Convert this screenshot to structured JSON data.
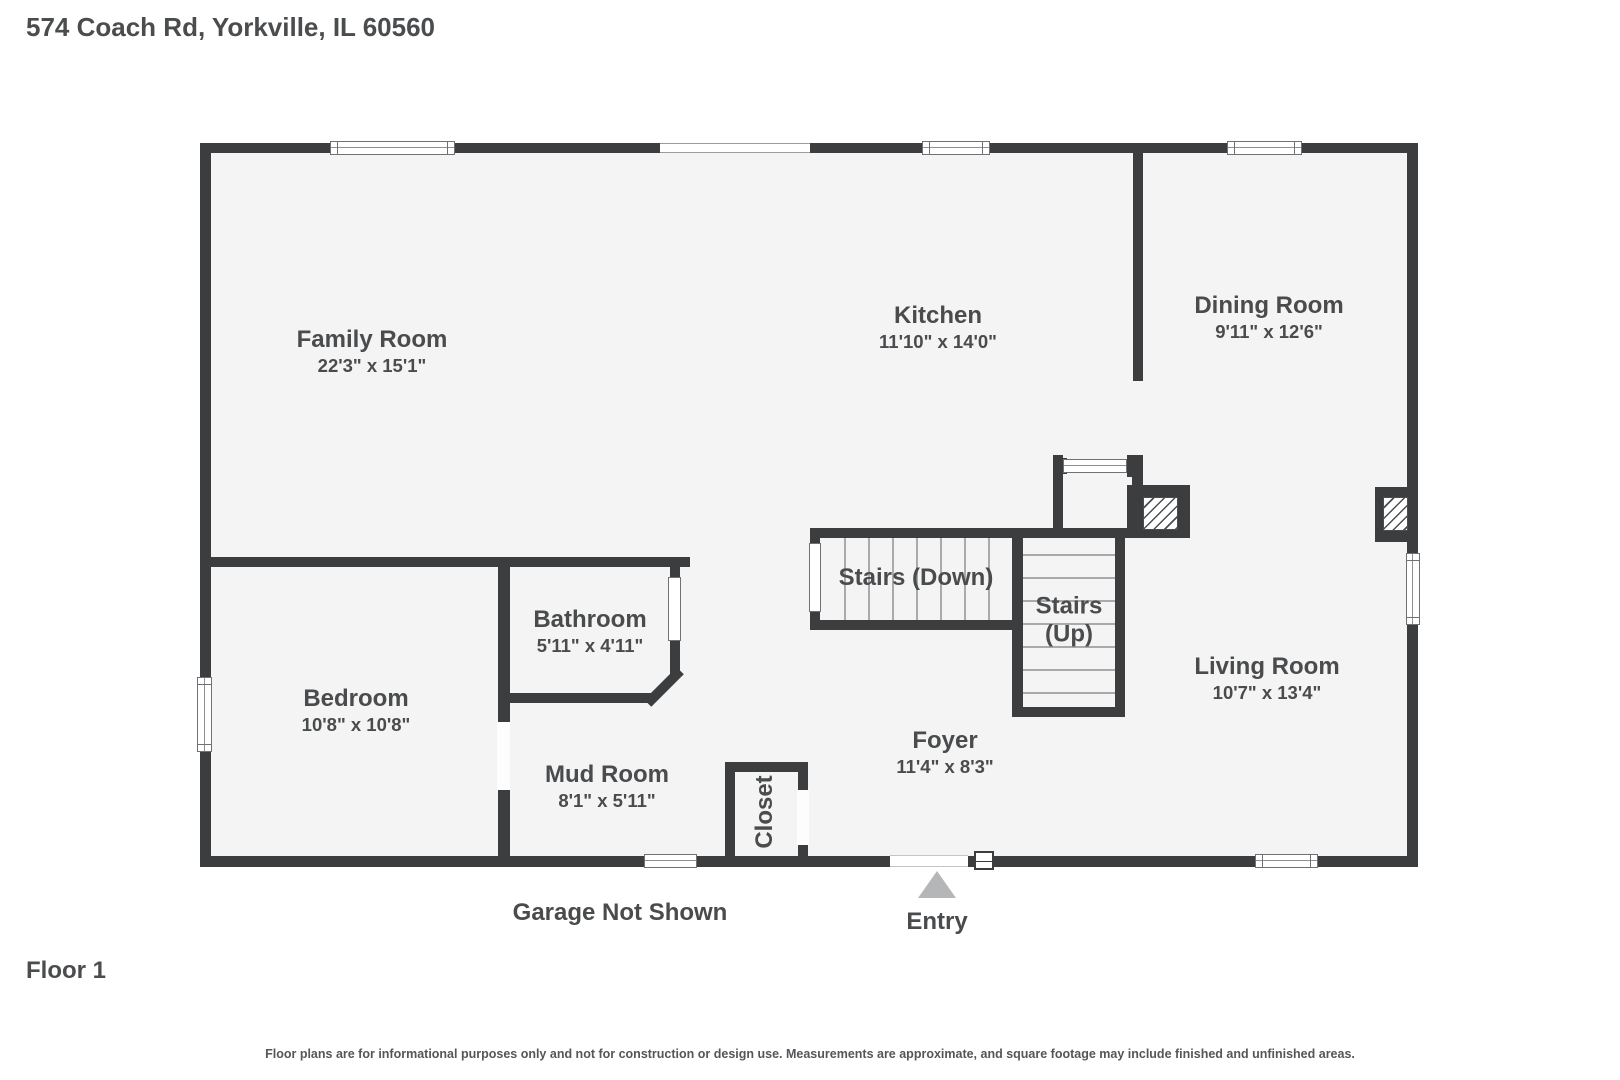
{
  "header": {
    "address": "574 Coach Rd, Yorkville, IL 60560"
  },
  "rooms": {
    "family_room": {
      "name": "Family Room",
      "dims": "22'3\" x 15'1\""
    },
    "kitchen": {
      "name": "Kitchen",
      "dims": "11'10\" x 14'0\""
    },
    "dining_room": {
      "name": "Dining Room",
      "dims": "9'11\" x 12'6\""
    },
    "living_room": {
      "name": "Living Room",
      "dims": "10'7\" x 13'4\""
    },
    "bathroom": {
      "name": "Bathroom",
      "dims": "5'11\" x 4'11\""
    },
    "bedroom": {
      "name": "Bedroom",
      "dims": "10'8\" x 10'8\""
    },
    "mud_room": {
      "name": "Mud Room",
      "dims": "8'1\" x 5'11\""
    },
    "foyer": {
      "name": "Foyer",
      "dims": "11'4\" x 8'3\""
    },
    "stairs_down": {
      "name": "Stairs (Down)"
    },
    "stairs_up": {
      "name": "Stairs (Up)"
    },
    "closet": {
      "name": "Closet"
    }
  },
  "annotations": {
    "entry": "Entry",
    "garage": "Garage Not Shown"
  },
  "footer": {
    "floor": "Floor 1",
    "disclaimer": "Floor plans are for informational purposes only and not for construction or design use. Measurements are approximate, and square footage may include finished and unfinished areas."
  },
  "colors": {
    "wall": "#3b3d3f",
    "floor": "#f4f4f4",
    "text": "#494b4d",
    "entry_arrow": "#b4b6b8"
  }
}
